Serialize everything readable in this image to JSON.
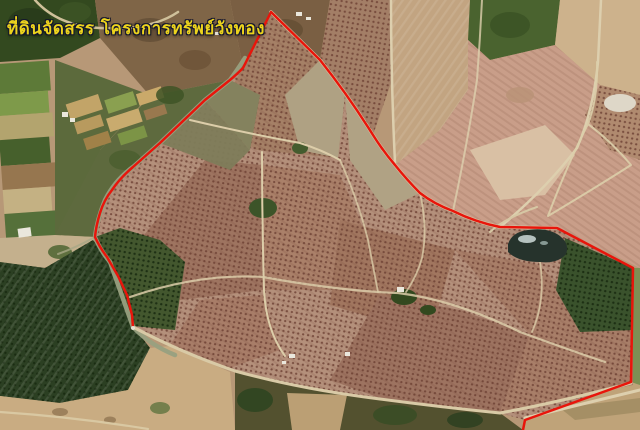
{
  "annotation": {
    "project_title": "ที่ดินจัดสรร โครงการทรัพย์วังทอง",
    "title_text_color": "#ecd31d",
    "title_outline_color": "#12152e"
  },
  "boundary": {
    "color": "#e8150b",
    "description": "red outline tracing the allocated land parcel over the aerial photo"
  },
  "terrain_colors": {
    "orchard_base": "#b4907b",
    "orchard_tree_dot": "#6b3e32",
    "dense_forest": "#2b3f22",
    "green_field": "#5d7a38",
    "dirt_road": "#e0d2b0",
    "sand": "#c9ac82",
    "pond_water": "#26332c",
    "pond_reflection": "#c5d2cf",
    "building_roof": "#eae7dc"
  }
}
